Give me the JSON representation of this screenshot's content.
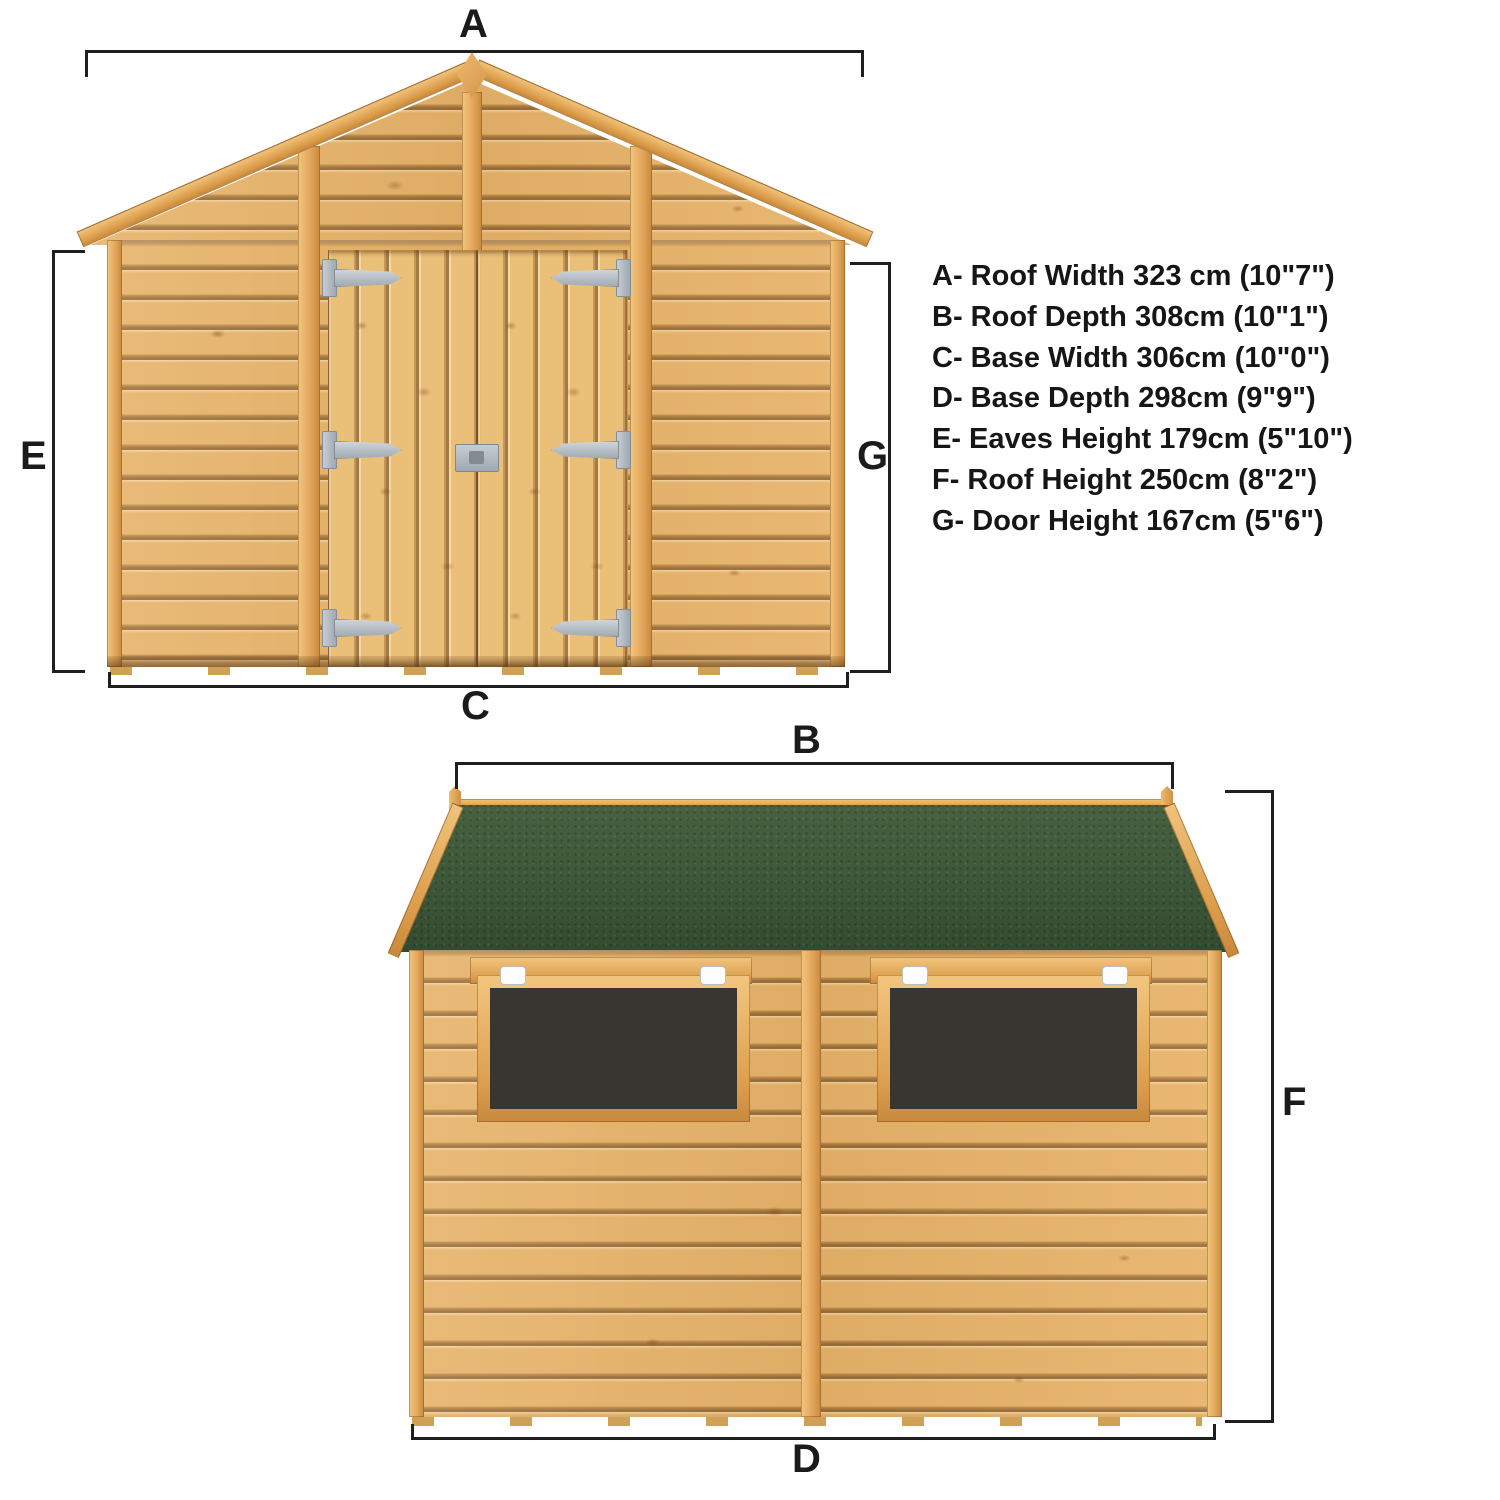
{
  "background": "#ffffff",
  "dimension_list": {
    "items": [
      "A- Roof Width 323 cm (10\"7\")",
      "B- Roof Depth 308cm (10\"1\")",
      "C- Base Width 306cm (10\"0\")",
      "D- Base Depth 298cm (9\"9\")",
      "E- Eaves Height 179cm (5\"10\")",
      "F- Roof Height 250cm (8\"2\")",
      "G- Door Height 167cm (5\"6\")"
    ]
  },
  "front_view": {
    "roof_width_label": "A",
    "base_width_label": "C",
    "eaves_height_label": "E",
    "door_height_label": "G"
  },
  "side_view": {
    "roof_depth_label": "B",
    "base_depth_label": "D",
    "roof_height_label": "F"
  },
  "colors": {
    "wood": "#e7b369",
    "trim": "#e0a457",
    "roof_felt_green": "#3f5939",
    "window_glass": "#393530",
    "hinge_metal": "#b7bfc7",
    "latch_white": "#fdfdfd",
    "dimension_line": "#1f1f1f",
    "background": "#ffffff"
  }
}
